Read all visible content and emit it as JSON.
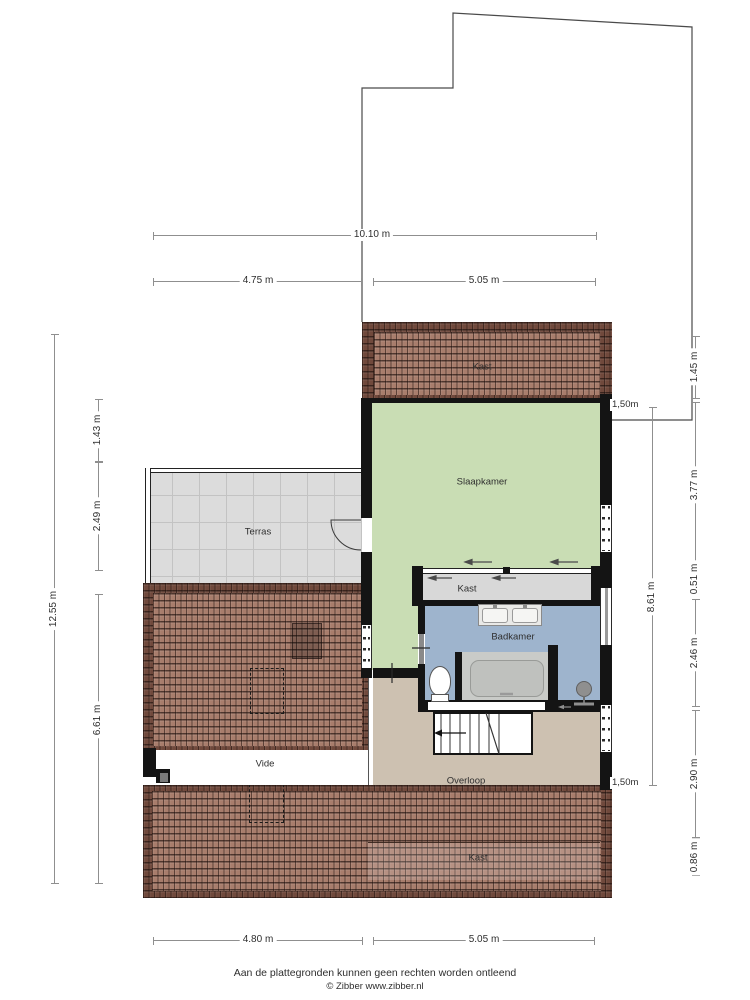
{
  "page": {
    "background": "#ffffff"
  },
  "rooms": {
    "kast_top": "Kast",
    "slaapkamer": "Slaapkamer",
    "terras": "Terras",
    "kast_wardrobe": "Kast",
    "badkamer": "Badkamer",
    "vide": "Vide",
    "overloop": "Overloop",
    "kast_bottom": "Kast"
  },
  "dimensions": {
    "top_total": "10.10 m",
    "top_left": "4.75 m",
    "top_right": "5.05 m",
    "bottom_left": "4.80 m",
    "bottom_right": "5.05 m",
    "left_total": "12.55 m",
    "left_seg1": "1.43 m",
    "left_seg2": "2.49 m",
    "left_seg3": "6.61 m",
    "right_inner_total": "8.61 m",
    "right_seg1": "1.45 m",
    "right_seg2": "3.77 m",
    "right_seg3": "0.51 m",
    "right_seg4": "2.46 m",
    "right_seg5": "2.90 m",
    "right_seg6": "0.86 m",
    "annotation_top": "1,50m",
    "annotation_bottom": "1,50m"
  },
  "footer": {
    "disclaimer": "Aan de plattegronden kunnen geen rechten worden ontleend",
    "credit": "© Zibber www.zibber.nl"
  },
  "colors": {
    "wall": "#141414",
    "slaapkamer_fill": "#c9ddb4",
    "badkamer_fill": "#9eb4cd",
    "overloop_fill": "#cdc1b1",
    "terras_fill": "#dcdcdc",
    "kast_fill": "#d8d8d8",
    "roof_dark": "#70493c",
    "roof_light": "#a87d6c",
    "dimension_line": "#8f8f8f"
  }
}
